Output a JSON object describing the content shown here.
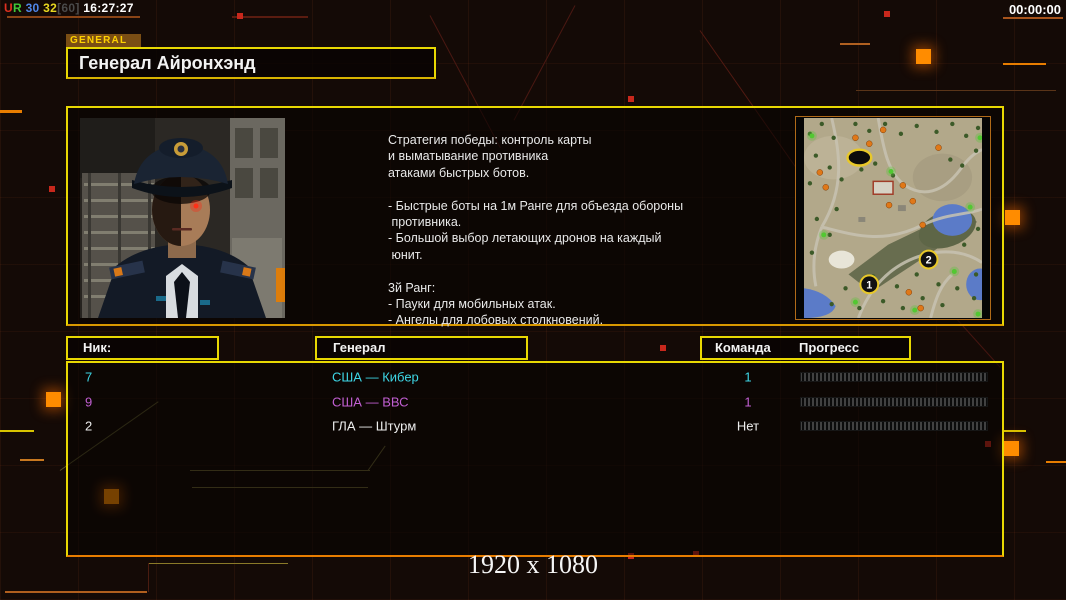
{
  "colors": {
    "accent_yellow": "#e8d802",
    "accent_orange": "#e87d00",
    "row_cyan": "#3ed6e6",
    "row_magenta": "#c15fd2",
    "row_white": "#eeeeee"
  },
  "hud": {
    "status_parts": [
      {
        "t": "U",
        "c": "#e03020"
      },
      {
        "t": "R",
        "c": "#3fc838"
      },
      {
        "t": " 30",
        "c": "#4f86e8"
      },
      {
        "t": " 32",
        "c": "#e8d820"
      },
      {
        "t": "[60]",
        "c": "#4a4a4a"
      },
      {
        "t": " 16:27:27",
        "c": "#ffffff"
      }
    ],
    "timer": "00:00:00"
  },
  "header": {
    "tab": "GENERAL",
    "title": "Генерал Айронхэнд"
  },
  "profile": {
    "bio": "Стратегия победы: контроль карты\nи выматывание противника\nатаками быстрых ботов.\n\n- Быстрые боты на 1м Ранге для объезда обороны\n противника.\n- Большой выбор летающих дронов на каждый\n юнит.\n\n3й Ранг:\n- Пауки для мобильных атак.\n- Ангелы для лобовых столкновений."
  },
  "minimap": {
    "markers": [
      "1",
      "2"
    ]
  },
  "table": {
    "headers": {
      "nick": "Ник:",
      "general": "Генерал",
      "team": "Команда",
      "progress": "Прогресс"
    },
    "rows": [
      {
        "nick": "7",
        "general": "США — Кибер",
        "team": "1",
        "color": "#3ed6e6"
      },
      {
        "nick": "9",
        "general": "США — ВВС",
        "team": "1",
        "color": "#c15fd2"
      },
      {
        "nick": "2",
        "general": "ГЛА — Штурм",
        "team": "Нет",
        "color": "#eeeeee"
      }
    ]
  },
  "footer": {
    "resolution": "1920 x 1080"
  }
}
